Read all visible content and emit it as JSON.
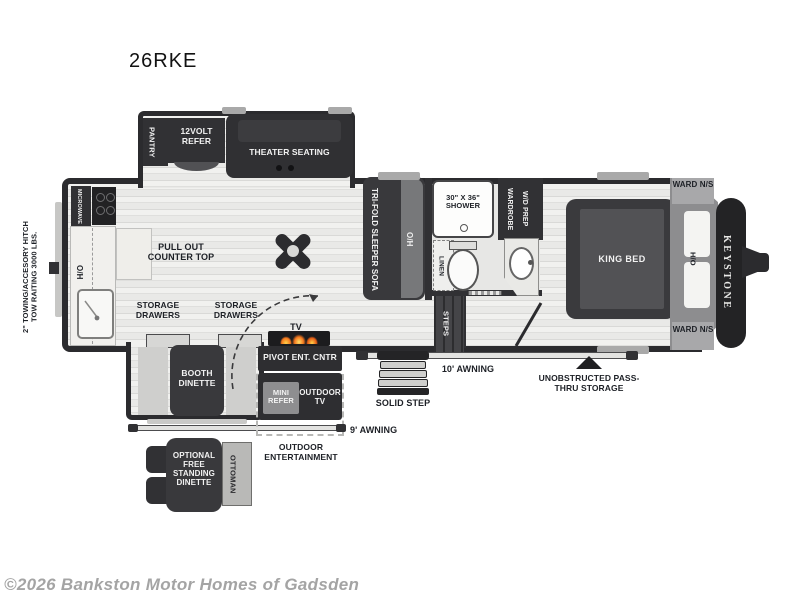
{
  "title": "26RKE",
  "footer": {
    "copyright": "©2026 Bankston Motor Homes of Gadsden"
  },
  "colors": {
    "wall": "#2b2b2e",
    "furniture_dark": "#313134",
    "floor_light": "#ebebe9",
    "cap_gray": "#8d8d8f",
    "ward_gray": "#a8a8aa",
    "flame_orange": "#f4761d",
    "label_dark": "#1d2026",
    "copyright_gray": "#a4a4a4"
  },
  "exterior": {
    "hitch_note_1": "2\" TOWING/ACCESORY HITCH",
    "hitch_note_2": "TOW RAITING 3000 LBS.",
    "awning_rear": "9' AWNING",
    "awning_main": "10' AWNING",
    "solid_step": "SOLID STEP",
    "pass_thru": "UNOBSTRUCTED PASS-THRU STORAGE",
    "brand": "KEYSTONE"
  },
  "kitchen": {
    "pantry": "PANTRY",
    "refer": "12VOLT REFER",
    "microwave": "MICROWAVE",
    "overhead": "O/H",
    "pull_out_counter": "PULL OUT COUNTER TOP",
    "storage_drawers": "STORAGE DRAWERS"
  },
  "living": {
    "theater_seating": "THEATER SEATING",
    "tri_fold_sofa": "TRI-FOLD SLEEPER SOFA",
    "sofa_overhead": "O/H",
    "booth_dinette": "BOOTH DINETTE",
    "tv": "TV",
    "pivot_ent": "PIVOT ENT. CNTR",
    "optional_dinette": "OPTIONAL FREE STANDING DINETTE",
    "ottoman": "OTTOMAN"
  },
  "outdoor": {
    "mini_refer": "MINI REFER",
    "outdoor_tv": "OUTDOOR TV",
    "outdoor_entertainment": "OUTDOOR ENTERTAINMENT"
  },
  "bath": {
    "shower": "30\" X 36\" SHOWER",
    "wardrobe": "WARDROBE W/D PREP",
    "linen": "LINEN",
    "steps": "STEPS"
  },
  "bedroom": {
    "king_bed": "KING BED",
    "ward_ns_top": "WARD N/S",
    "ward_ns_bottom": "WARD N/S",
    "ho_cabinet": "H/O"
  }
}
